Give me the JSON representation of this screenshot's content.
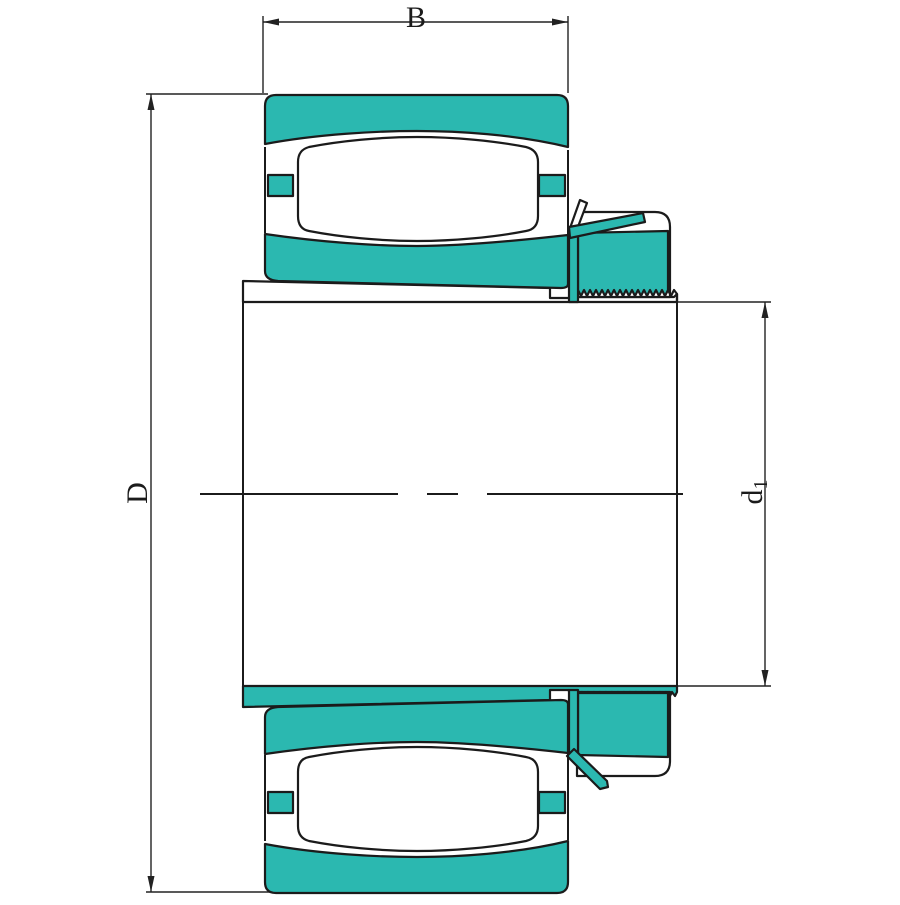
{
  "dimensions": {
    "width_label": "B",
    "outer_diameter_label": "D",
    "sleeve_bore_label": {
      "main": "d",
      "sub": "1"
    }
  },
  "colors": {
    "part_fill": "#2bb8b0",
    "part_white": "#ffffff",
    "outline": "#1b1b1b",
    "line": "#222222",
    "background": "#ffffff"
  }
}
